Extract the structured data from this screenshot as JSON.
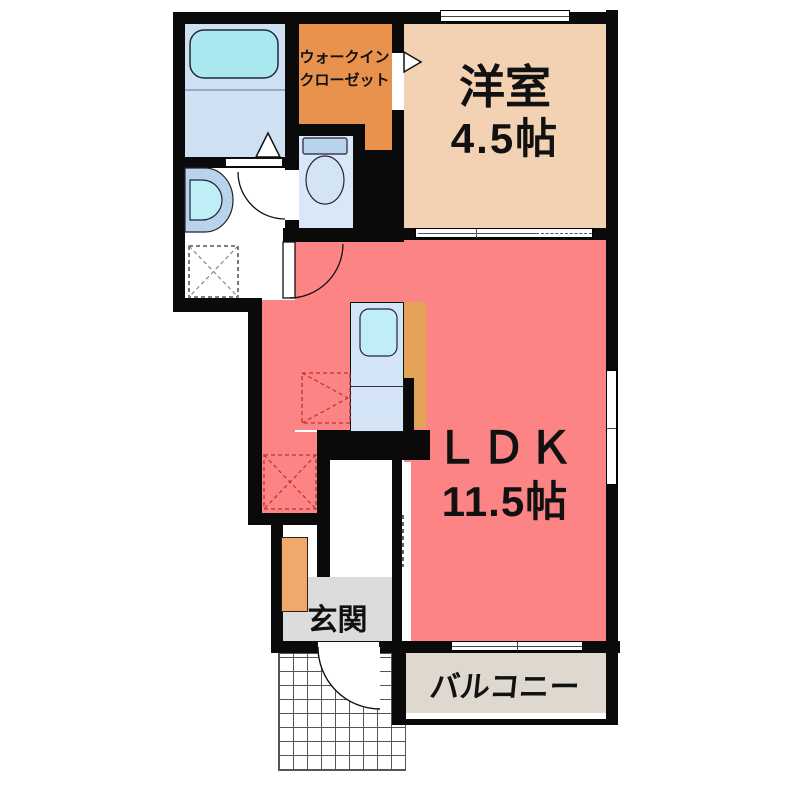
{
  "type": "japanese-apartment-floor-plan",
  "colors": {
    "wall": "#0a0a0a",
    "ldk": "#fc8484",
    "yoshitsu": "#f2d2b2",
    "wic": "#e8924e",
    "counter": "#e2a257",
    "cabinet": "#f0a96a",
    "bath_floor": "#cfe0f3",
    "tub": "#aae8f0",
    "fixture_blue": "#b9d3ec",
    "bowl_cyan": "#bfeef6",
    "toilet_floor": "#d8e8f8",
    "toilet_bowl": "#d3e4f5",
    "kitchen_unit": "#d3e4f7",
    "genkan": "#dcdcdc",
    "balcony": "#ded8ce",
    "text": "#111111",
    "dashed_red": "#bb3333",
    "dashed_gray": "#888888"
  },
  "rooms": {
    "wic": {
      "label_line1": "ウォークイン",
      "label_line2": "クローゼット"
    },
    "yoshitsu": {
      "name": "洋室",
      "size": "4.5帖"
    },
    "ldk": {
      "name": "ＬＤＫ",
      "size": "11.5帖"
    },
    "genkan": {
      "name": "玄関"
    },
    "balcony": {
      "name": "バルコニー"
    }
  },
  "fixtures": {
    "bathtub": "bathtub",
    "washbasin": "washbasin",
    "toilet": "toilet",
    "kitchen_sink": "kitchen-sink",
    "washing_machine_space": "washing-machine-space-dashed",
    "refrigerator_space": "refrigerator-space-dashed",
    "cupboard_space": "cupboard-space-dashed",
    "shoe_cabinet": "shoe-cabinet"
  }
}
